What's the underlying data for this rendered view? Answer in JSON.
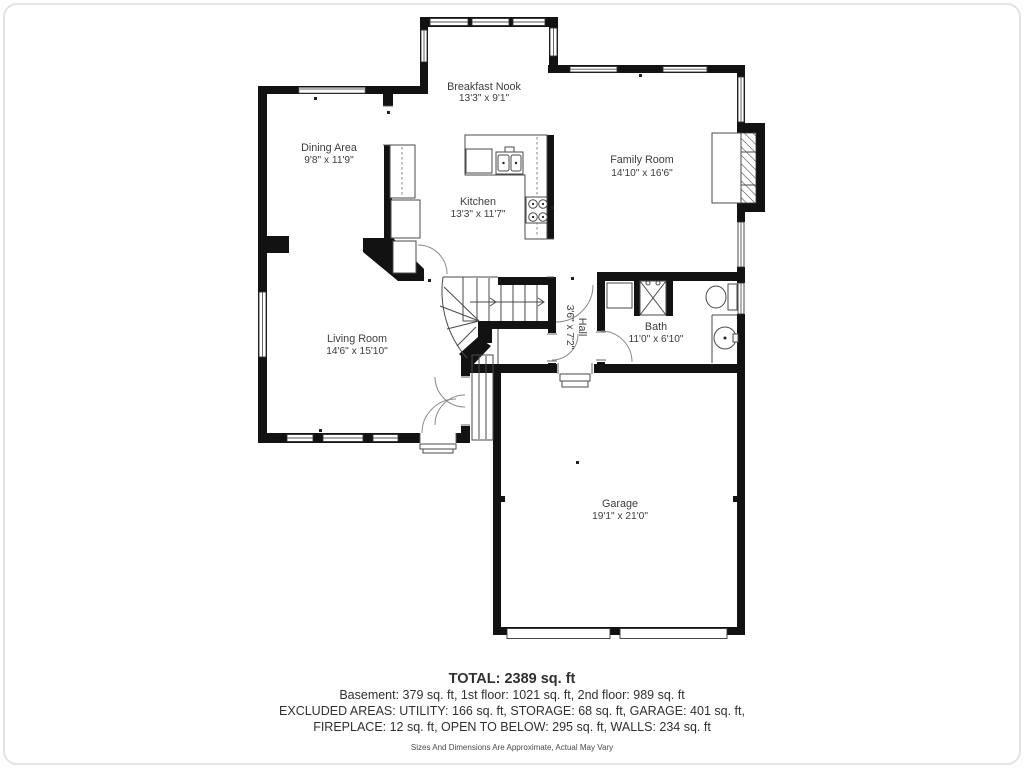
{
  "title": "First floor plan",
  "rooms": [
    {
      "id": "breakfast-nook",
      "name": "Breakfast Nook",
      "dims": "13'3\" x 9'1\""
    },
    {
      "id": "dining-area",
      "name": "Dining Area",
      "dims": "9'8\" x 11'9\""
    },
    {
      "id": "family-room",
      "name": "Family Room",
      "dims": "14'10\" x 16'6\""
    },
    {
      "id": "kitchen",
      "name": "Kitchen",
      "dims": "13'3\" x 11'7\""
    },
    {
      "id": "living-room",
      "name": "Living Room",
      "dims": "14'6\" x 15'10\""
    },
    {
      "id": "hall",
      "name": "Hall",
      "dims": "3'6\" x 7'2\""
    },
    {
      "id": "bath",
      "name": "Bath",
      "dims": "11'0\" x 6'10\""
    },
    {
      "id": "garage",
      "name": "Garage",
      "dims": "19'1\" x 21'0\""
    }
  ],
  "summary": {
    "total": "TOTAL: 2389 sq. ft",
    "floors": "Basement: 379 sq. ft, 1st floor: 1021 sq. ft, 2nd floor: 989 sq. ft",
    "excluded_line1": "EXCLUDED AREAS: UTILITY: 166 sq. ft, STORAGE: 68 sq. ft, GARAGE: 401 sq. ft,",
    "excluded_line2": "FIREPLACE: 12 sq. ft, OPEN TO BELOW: 295 sq. ft, WALLS: 234 sq. ft",
    "disclaimer": "Sizes And Dimensions Are Approximate, Actual May Vary"
  },
  "colors": {
    "wall": "#121212",
    "line": "#4a4a4a",
    "text": "#3d3d3d"
  }
}
